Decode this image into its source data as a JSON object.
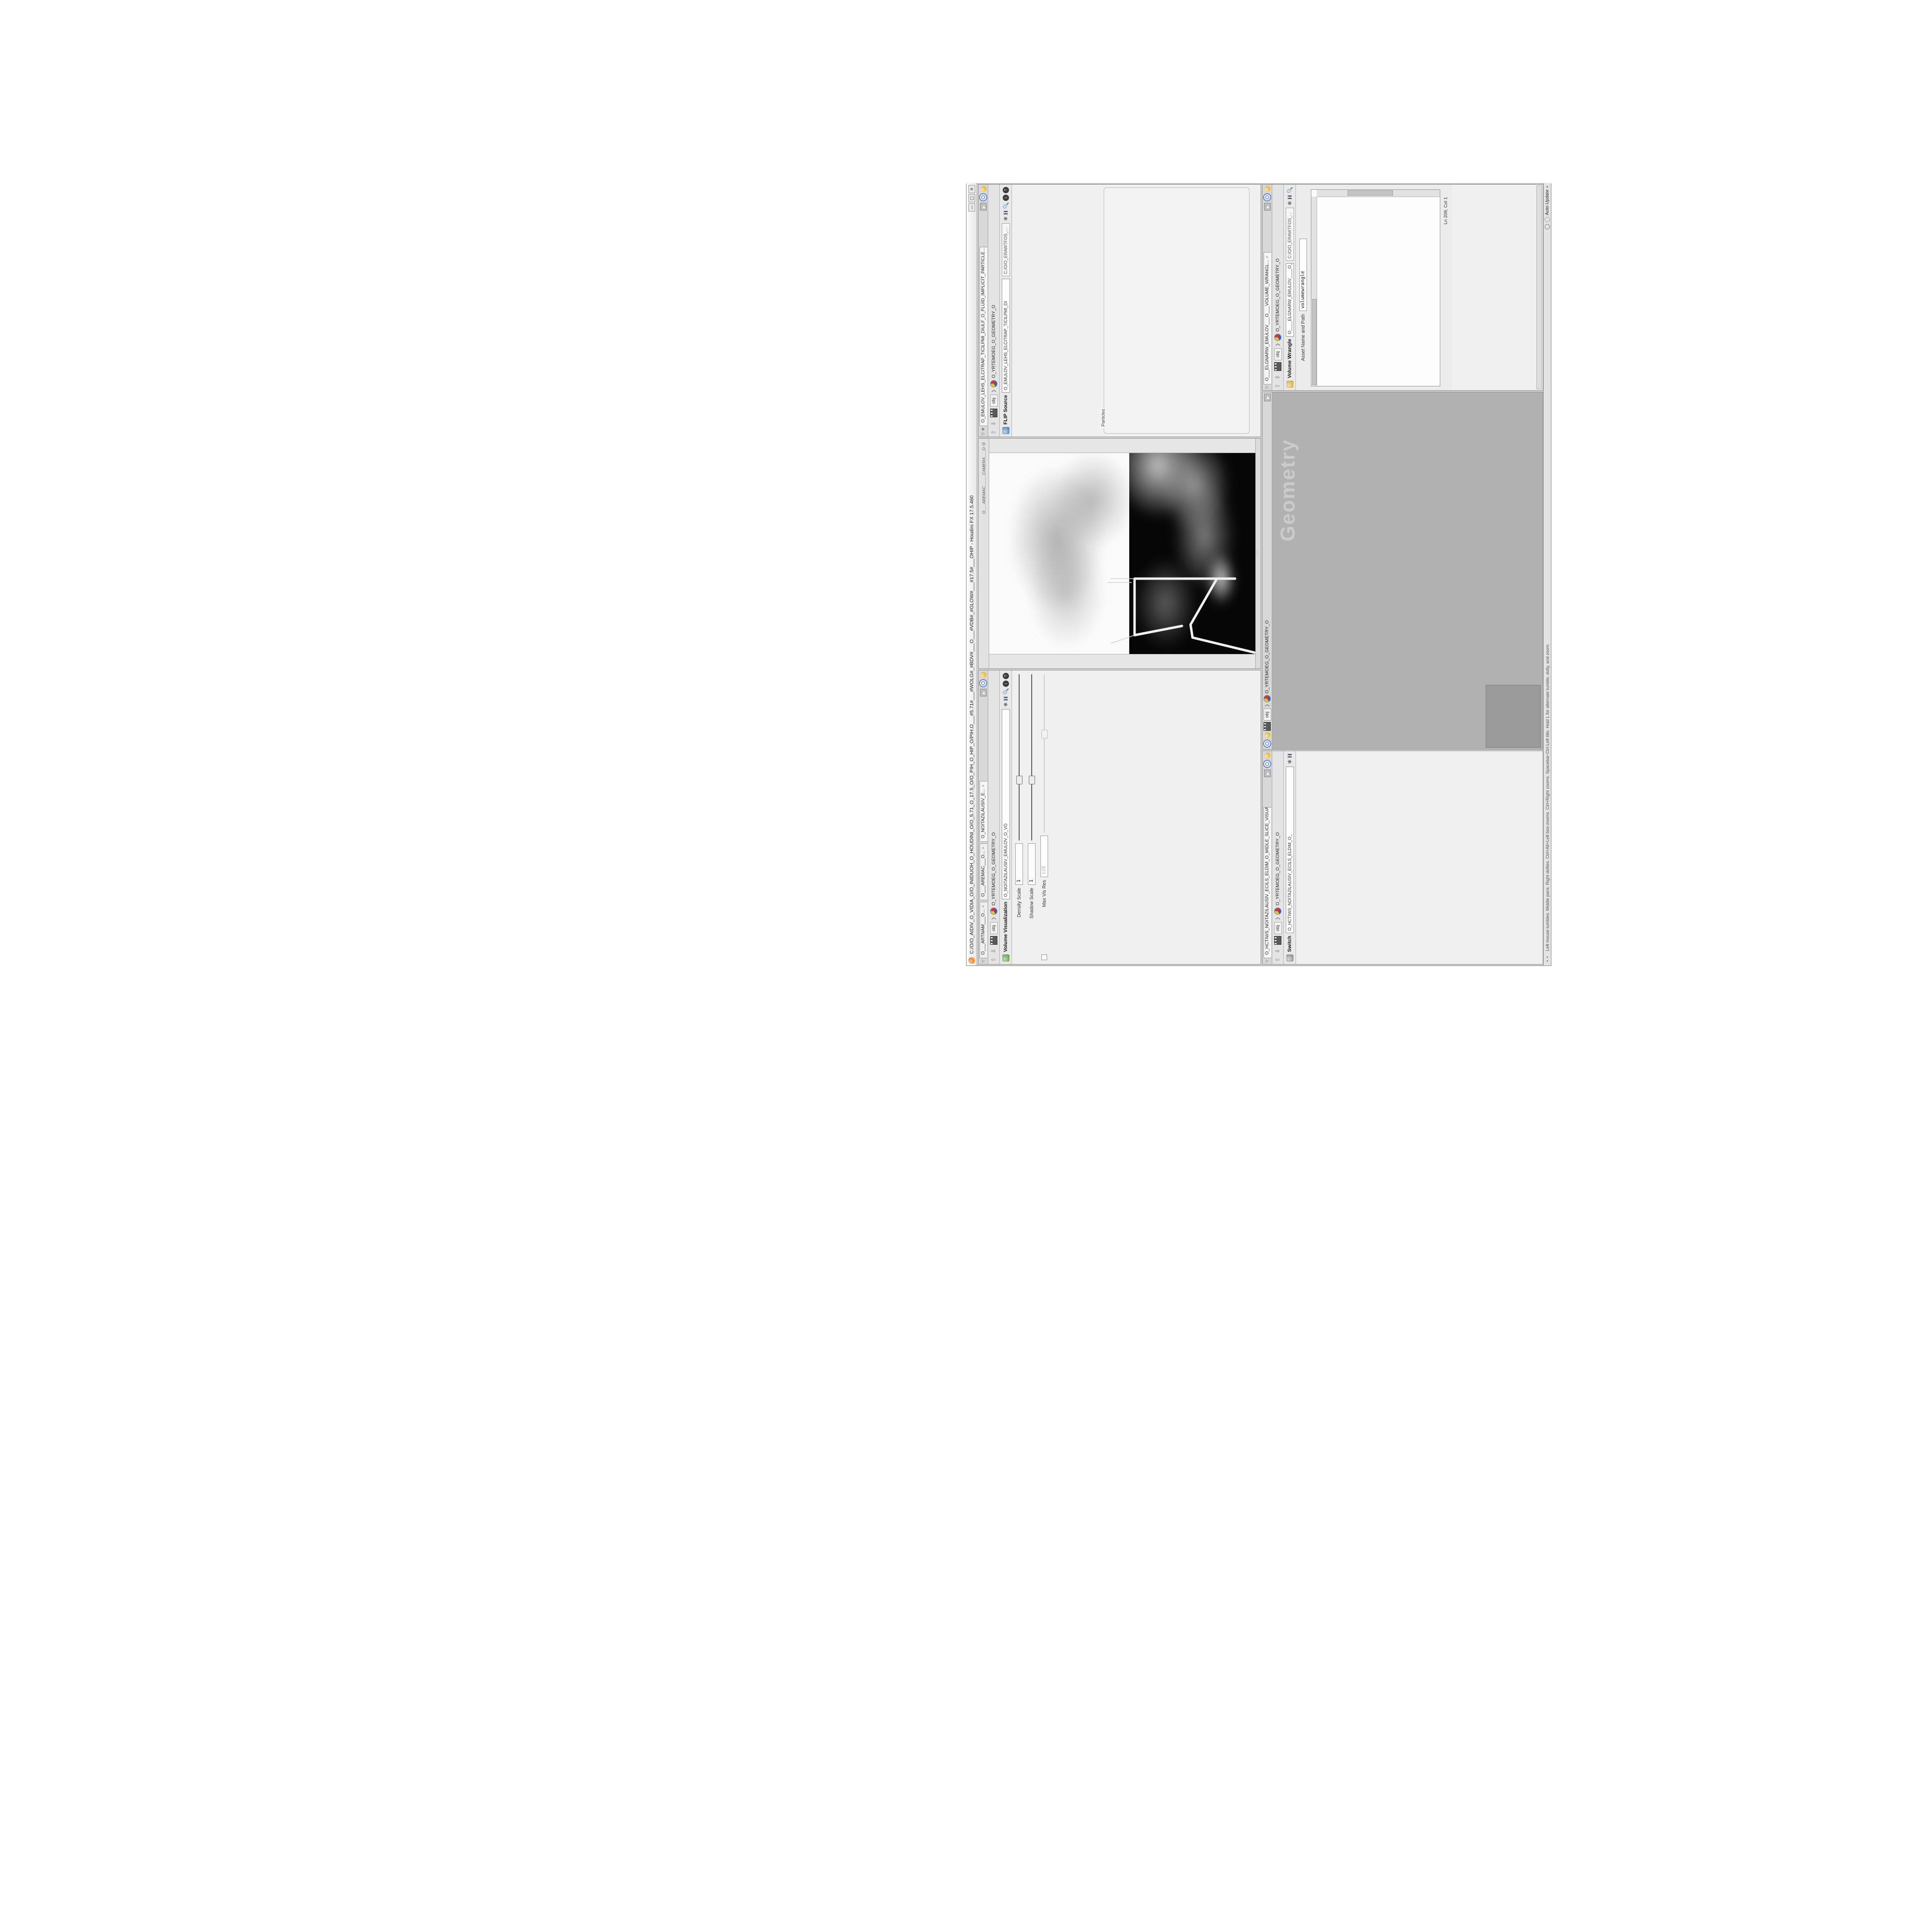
{
  "window": {
    "title": "C:/O/O_AIDIV_O_VIDIA_O/O_INIDUOH_O_HOUDINI_O/O_5.71_O_17.5_O/O_PIH_O_HIP_O/PIH.O___#5.71#___#WOLG#_#BDV#___O___#VDB#_#GLOW#___#17.5#___OHIP - Houdini FX 17.5.460",
    "buttons": {
      "minimize": "—",
      "maximize": "▢",
      "close": "✕"
    }
  },
  "statusbar": {
    "hint": "Left mouse tumbles. Middle pans. Right dollies. Ctrl+Alt+Left box-zooms. Ctrl+Right zooms. Spacebar-Ctrl-Left tilts. Hold L for alternate tumble, dolly, and zoom.",
    "auto_update": "Auto Update"
  },
  "volvis": {
    "tabs": [
      "O___ARTNAM___O...",
      "O___AREMAC___O...",
      "O_NOITAZILAUSIV_E..."
    ],
    "breadcrumb_root": "obj",
    "breadcrumb_node": "O_YRTEMOEG_O_GEOMETRY_O",
    "type_label": "Volume Visualization",
    "name_value": "O_NOITAZILAUSIV_EMULOV_O_VO",
    "rows": [
      {
        "label": "Density Scale",
        "value": "1",
        "kind": "slider",
        "thumb": 0.36
      },
      {
        "label": "Shadow Scale",
        "value": "1",
        "kind": "slider",
        "thumb": 0.36
      },
      {
        "label": "Max Vis Res",
        "value": "128",
        "kind": "slider",
        "thumb": 0.62,
        "disabled": true,
        "precheck": true
      },
      {
        "kind": "tabs",
        "tabs": [
          "Smoke",
          "Emission"
        ],
        "active": 0
      },
      {
        "label": "Density Field",
        "value": "density",
        "kind": "field",
        "bold": true
      },
      {
        "label": "Mode",
        "kind": "mode",
        "values": [
          "Clamped Ramp",
          "Density",
          "Presets"
        ]
      },
      {
        "label": "Density Ramp",
        "kind": "ramp",
        "ramp": "density"
      },
      {
        "label": "Diffuse Field",
        "value": "density",
        "kind": "field",
        "bold": true
      },
      {
        "label": "Diffuse Range",
        "kind": "field2",
        "values": [
          "0",
          "1"
        ],
        "disabled": true
      },
      {
        "label": "Mode",
        "kind": "mode",
        "values": [
          "Clamped Ramp",
          "Diffuse",
          "Presets"
        ]
      },
      {
        "label": "Diffuse Ramp",
        "kind": "ramp",
        "ramp": "diffuse"
      },
      {
        "label": "Point No.",
        "value": "1",
        "kind": "slider",
        "thumb": 0.08
      },
      {
        "label": "Position",
        "value": "0",
        "kind": "slider",
        "thumb": 0.04
      },
      {
        "label": "Color",
        "kind": "color"
      },
      {
        "label": "Interpolation",
        "value": "Linear",
        "kind": "dropdown"
      },
      {
        "label": "",
        "kind": "vec3",
        "values": [
          "1.8125",
          "1.8125",
          "1.8125"
        ]
      }
    ]
  },
  "viewport": {
    "camera_label": "O___AREMAC_____CAMERA___O",
    "lock_icon": "@",
    "layout_icons": [
      {
        "name": "single-view-icon",
        "glyph": "▢"
      },
      {
        "name": "shaded-spheres-icon",
        "glyph": "◉"
      },
      {
        "name": "wire-cube-icon",
        "glyph": "▣"
      },
      {
        "name": "target-icon",
        "glyph": "◎"
      }
    ],
    "left_toolbar": [
      {
        "name": "view-tool-icon",
        "glyph": "▣",
        "color": "#6b6b6b",
        "boxed": true
      },
      {
        "name": "select-tool-icon",
        "glyph": "✥",
        "color": "#b23b2e"
      },
      {
        "name": "move-tool-icon",
        "glyph": "✣",
        "color": "#c24a3a"
      },
      {
        "name": "rotate-tool-icon",
        "glyph": "↻",
        "color": "#c24a3a"
      },
      {
        "name": "scissors-icon",
        "glyph": "✂",
        "color": "#8d8d8d"
      },
      {
        "name": "axis-gadget-icon",
        "glyph": "▲",
        "color": "#3f8f3f"
      },
      {
        "name": "separator",
        "glyph": "──",
        "sep": true
      },
      {
        "name": "grid-snap-icon",
        "glyph": "⊞",
        "color": "#b23b2e"
      },
      {
        "name": "magnet-point-icon",
        "glyph": "Ω",
        "color": "#b23b2e"
      },
      {
        "name": "magnet-edge-icon",
        "glyph": "Ω",
        "color": "#c2675a"
      },
      {
        "name": "magnet-multi-icon",
        "glyph": "Ω",
        "color": "#b23b2e"
      },
      {
        "name": "separator",
        "glyph": "──",
        "sep": true
      },
      {
        "name": "bar-play-icon",
        "glyph": "▮▸",
        "color": "#6e6e6e"
      },
      {
        "name": "brush-icon",
        "glyph": "❥",
        "color": "#8d8d8d"
      },
      {
        "name": "sphere-icon",
        "glyph": "●",
        "color": "#9a9a9a"
      }
    ],
    "right_toolbar": [
      {
        "name": "scroll-up-icon",
        "glyph": "◂",
        "color": "#9a9a9a"
      },
      {
        "name": "axis-icon",
        "glyph": "✦",
        "color": "#7d7d5e"
      },
      {
        "name": "grid-panel-icon",
        "glyph": "▦",
        "color": "#4e8f4e"
      },
      {
        "name": "lock-handle-icon",
        "glyph": "◨",
        "color": "#6b6b6b",
        "boxed": true
      },
      {
        "name": "no-lights-icon",
        "glyph": "⊘",
        "color": "#8a8a8a"
      },
      {
        "name": "striped-sphere-icon",
        "glyph": "◍",
        "color": "#7c7c7c"
      },
      {
        "name": "headlight-icon",
        "glyph": "◖",
        "color": "#9d9d83"
      },
      {
        "name": "normal-lights-icon",
        "glyph": "◉",
        "color": "#b8b23c"
      },
      {
        "name": "hq-light-icon",
        "glyph": "◉",
        "color": "#8f8f4a",
        "boxed": true
      },
      {
        "name": "shadows-icon",
        "glyph": "◕",
        "color": "#4e4e4e",
        "boxed": true
      },
      {
        "name": "material-pencil-icon",
        "glyph": "✎",
        "color": "#7a7a7a"
      },
      {
        "name": "clip-sphere-icon",
        "glyph": "◔",
        "color": "#8a8a8a"
      },
      {
        "name": "separator",
        "glyph": "──",
        "sep": true
      },
      {
        "name": "dot-icon",
        "glyph": "○",
        "color": "#8a8a8a"
      },
      {
        "name": "key-icon",
        "glyph": "⚿",
        "color": "#8a8a8a"
      },
      {
        "name": "pen-icon",
        "glyph": "✐",
        "color": "#8a8a8a"
      },
      {
        "name": "machine-icon",
        "glyph": "⚙",
        "color": "#8a8a8a"
      },
      {
        "name": "sheet-icon",
        "glyph": "❏",
        "color": "#8a8a8a"
      },
      {
        "name": "sheet2-icon",
        "glyph": "❐",
        "color": "#8a8a8a"
      },
      {
        "name": "scroll-down-icon",
        "glyph": "▸",
        "color": "#9a9a9a"
      }
    ]
  },
  "flip": {
    "tab": "O_EMULOV_LEHS_ELCITRAP_TICILPMI_DIULF_O_FLUID_IMPLICIT_PARTICLE...",
    "breadcrumb_root": "obj",
    "breadcrumb_node": "O_YRTEMOEG_O_GEOMETRY_O",
    "type_label": "FLIP Source",
    "name_value": "O_EMULOV_LEHS_ELCITRAP_TICILPMI_DI",
    "path_value": "C:/O/O_ERAWTFOS_...",
    "rows": [
      {
        "label": "Asset Name and Path",
        "value": "flipsource",
        "kind": "field"
      },
      {
        "label": "Initialize",
        "value": "Source FLIP",
        "kind": "dropdown"
      },
      {
        "label": "Volume Name",
        "value": "density",
        "kind": "field",
        "bold": true
      },
      {
        "label": "Voxel Size",
        "value": "1/27",
        "kind": "slider",
        "yellow": true,
        "thumb": 0.3,
        "flag": true
      },
      {
        "label": "Shell Thickness",
        "value": "3",
        "kind": "slider",
        "thumb": 0.52
      },
      {
        "label": "Output Fog",
        "kind": "check"
      },
      {
        "label": "Fog Boost",
        "value": "0",
        "kind": "slider",
        "disabled": true,
        "thumb": 0.05
      }
    ],
    "particles_group": "Particles",
    "particles_rows": [
      {
        "label": "Create Particles",
        "kind": "check"
      },
      {
        "label": "Particle Group",
        "value": "particles",
        "kind": "field",
        "disabled": true
      },
      {
        "label": "Particle Separation",
        "value": "1/9",
        "kind": "slider",
        "disabled": true,
        "thumb": 0.25
      },
      {
        "label": "Jitter Seed",
        "value": "0",
        "kind": "slider",
        "disabled": true,
        "thumb": 0.05
      },
      {
        "label": "Jitter Scale",
        "value": "0",
        "kind": "slider",
        "disabled": true,
        "thumb": 0.05
      },
      {
        "label": "Oversampling",
        "value": "2",
        "kind": "slider",
        "disabled": true,
        "thumb": 0.4
      },
      {
        "label": "Oversampling Bandwi...",
        "value": "1",
        "kind": "slider",
        "disabled": true,
        "thumb": 0.3
      },
      {
        "label": "Velocity",
        "value": "0",
        "kind": "slider",
        "disabled": true,
        "thumb": 0.05
      },
      {
        "label": "Add Rest Attribute",
        "kind": "check"
      },
      {
        "label": "Dual Rest Attributes",
        "kind": "check",
        "checked": true
      },
      {
        "label": "Rest Offset",
        "value": "0",
        "kind": "slider",
        "disabled": true,
        "thumb": 0.05
      }
    ]
  },
  "switchpane": {
    "tab": "O_HCTIWS_NOITAZILAUSIV_ECILS_ELDIM_O_MIDLE_SLICE_VISUALIZATION...",
    "breadcrumb_root": "obj",
    "breadcrumb_node": "O_YRTEMOEG_O_GEOMETRY_O",
    "type_label": "Switch",
    "name_value": "O_HCTIWS_NOITAZILAUSIV_ECILS_ELDIM_O_",
    "rows": [
      {
        "label": "Select Input",
        "value": "0",
        "kind": "slider",
        "thumb": 0.03
      },
      {
        "label": "Input Operators (Drag/Drop to reorder)",
        "kind": "label"
      }
    ],
    "operators": [
      "O_NOITAZILAUSIV_EMULOV_O_VOLUME_VISUALIZATION_O",
      "O_MROFSNART_ECILS_ELDIM_O_MIDLE_SLICE_TRANSFORM_O"
    ],
    "selected_operator": 0
  },
  "network": {
    "breadcrumb_root": "obj",
    "breadcrumb_node": "O_YRTEMOEG_O_GEOMETRY_O",
    "path": "/obj/O_YRTEMOEG_O_GEOMETRY_O",
    "watermark": "Geometry",
    "nodes": [
      {
        "type": "an_CubeSphere",
        "name": "O_EREHPS_EBUC_O_CUBE_SPHERE_O",
        "color": "#3f7f4f"
      },
      {
        "type": "PolyWire",
        "name": "O_EMARFERIW_NOGYLOP_EREHPS_EBUC_O_CUBE_SPHERE_POLYGON_W...",
        "color": "#55607a"
      },
      {
        "type": "File",
        "name": "JBO.ND3.PETS.TFOLS.D...D.SLOFT.STEP.3DN.OBJ",
        "color": "#d07a28",
        "blue": true
      },
      {
        "type": "Switch",
        "name": "O_HCTIWS_YRTEMOEG_LANRETXE_O_EXTERNAL_GEOMETRY_SWITCH_O",
        "color": "#7a7a7a"
      },
      {
        "type": "Clip",
        "name": "O_PILC_EMULOV_O_VOLUME_CLIP_O",
        "color": "#b05a3c"
      },
      {
        "type": "FLIP Source",
        "name": "O_EMULOV_LEHS_ELCITRAP_TICILPMI_DIULF_O_FLUID_IMPLIC...",
        "color": "#e8e8e8"
      },
      {
        "type": "VDB from Polygons",
        "name": "O_SNOGILOP_YRTEMOEG_MORF_EMULOV_BDV_O_VDB_VOLUM...",
        "color": "#b03030"
      },
      {
        "type": "Volume Wrangle",
        "name": "O___ELGNARW_EMULOV___O___VOLUME_WRANGLE___O",
        "color": "#c8a828"
      },
      {
        "type": "VolumeVisualization",
        "name": "O_NOITAZILAUSIV_EMULOV_O_VOLUME_VISUALIZATION_O",
        "color": "#3f7f3f"
      },
      {
        "type": "Transform",
        "name": "O_MROFSNART_ECILS_ELDIM_O_MIDLE_SLICE_TRANSFOR...",
        "color": "#5a7ab0"
      },
      {
        "type": "Switch",
        "name": "O_HCTIWS_NOITAZILAUSIV_ECILS_ELDIM_O_MIDLE_SLICE_VIS...",
        "color": "#7a7a7a"
      },
      {
        "type": "Merge",
        "name": "O_ECAFRUS_HTIW_EMULOV_EGREM_O_MERGE_VOLUME_WITH_SURFACE...",
        "color": "#6a6a8a"
      },
      {
        "type": "Transform",
        "name": "O_MROFSNART_TLUSER_O_RESULT_TRANSFORM_O",
        "color": "#9b8cf0",
        "big": true
      }
    ]
  },
  "wrangle": {
    "tab": "O___ELGNARW_EMULOV___O___VOLUME_WRANGL...",
    "breadcrumb_root": "obj",
    "breadcrumb_node": "O_YRTEMOEG_O_GEOMETRY_O",
    "type_label": "Volume Wrangle",
    "name_value": "O____ELGNARW_EMULOV____O____VOI",
    "path_value": "C:/O/O_ERAWTFOS_...",
    "asset_label": "Asset Name and Path",
    "asset_value": "volumewrangle",
    "code_lines": [
      {
        "k": "c",
        "s": "//// @ 0D3%steserPym62%0D3%eziSym62%000.1D3%C62%000.."
      },
      {
        "k": "c",
        "s": "//// @ 0D3%steserPym62%0D3%eziSym62%000.1D3%C62%000.."
      },
      {
        "k": "c",
        "s": "//// @ \\\\\\\\"
      },
      {
        "k": "c",
        "s": "//// @ HTTP://MEMORYST@MP.C@M/graphtoy/#draw1%3Dtru"
      },
      {
        "k": "c",
        "s": "//// @ HTTP://MEMORYST@MP.C@M/graphtoy/#draw1%3Dtru"
      },
      {
        "k": "c",
        "s": ""
      },
      {
        "k": "mix",
        "segs": [
          [
            "@density=((        ((",
            "d"
          ],
          [
            "pow",
            "t"
          ],
          [
            "((        1./ (1.-",
            "d"
          ],
          [
            "cla",
            "t"
          ]
        ]
      },
      {
        "k": "c",
        "s": ""
      },
      {
        "k": "c",
        "s": "//// @ 0D3%steserPym62%0D3%eziSym62%000.1D3%C62%000.."
      },
      {
        "k": "c",
        "s": "//// @ 0D3%steserPym62%0D3%eziSym62%000.1D3%C62%000.."
      },
      {
        "k": "c",
        "s": "//// @ \\\\\\\\"
      },
      {
        "k": "c",
        "s": "//// @ HTTP://MEMORYST@MP.C@M/graphtoy/#draw1%3Dtru"
      },
      {
        "k": "c",
        "s": "//// @ HTTP://MEMORYST@MP.C@M/graphtoy/#draw1%3Dtru"
      }
    ],
    "cursor_status": "Ln 209, Col 1",
    "rows": [
      {
        "label": "Volumes to Write to",
        "value": "*",
        "kind": "field"
      },
      {
        "label": "Enforce Prototypes",
        "kind": "check"
      },
      {
        "label": "O_REWOP_O_POWER...",
        "value": "6",
        "kind": "slider",
        "thumb": 0.3
      },
      {
        "label": "O_ELACS_O_SCALE_O",
        "value": "32",
        "kind": "slider",
        "thumb": 0.82
      },
      {
        "label": "O_TFIHS_O_SHIFT_O",
        "value": "1.4375",
        "kind": "slider",
        "thumb": 0.57
      }
    ]
  }
}
